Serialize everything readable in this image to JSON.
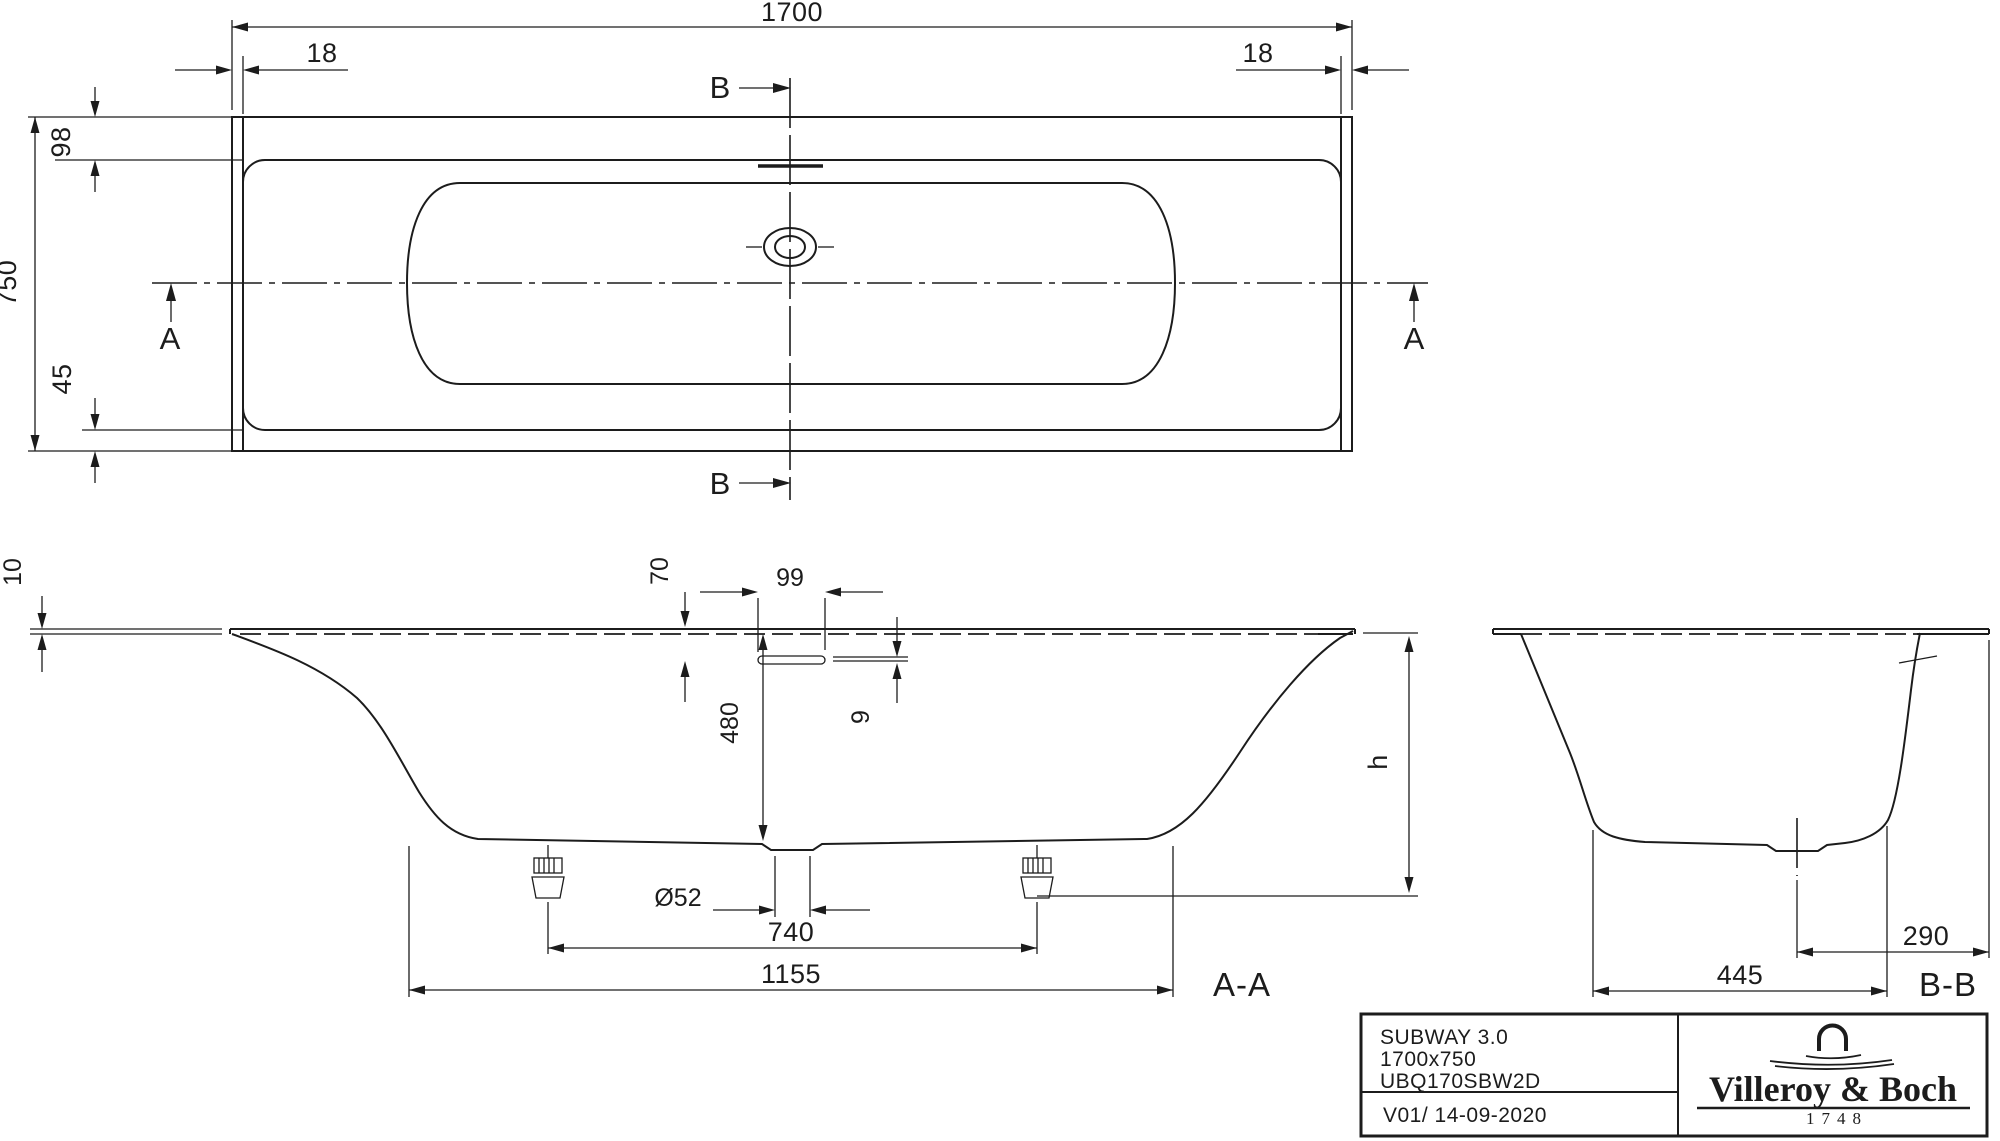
{
  "top_view": {
    "length": "1700",
    "rim_end_left": "18",
    "rim_end_right": "18",
    "rim_back_width": "98",
    "overall_width": "750",
    "rim_front_width": "45",
    "section_a_marker": "A",
    "section_b_marker": "B"
  },
  "section_aa": {
    "label": "A-A",
    "rim_thickness": "10",
    "overflow_drop": "70",
    "overflow_slot_length": "99",
    "inner_depth": "480",
    "overflow_slot_height": "9",
    "drain_diameter": "Ø52",
    "feet_spacing": "740",
    "base_length": "1155",
    "height_ref": "h"
  },
  "section_bb": {
    "label": "B-B",
    "base_width": "445",
    "drain_offset": "290"
  },
  "title_block": {
    "model": "SUBWAY 3.0",
    "size": "1700x750",
    "article_number": "UBQ170SBW2D",
    "version": "V01/ 14-09-2020",
    "brand": "Villeroy & Boch",
    "established": "1748"
  },
  "colors": {
    "line": "#1c1c1c",
    "background": "#ffffff"
  }
}
